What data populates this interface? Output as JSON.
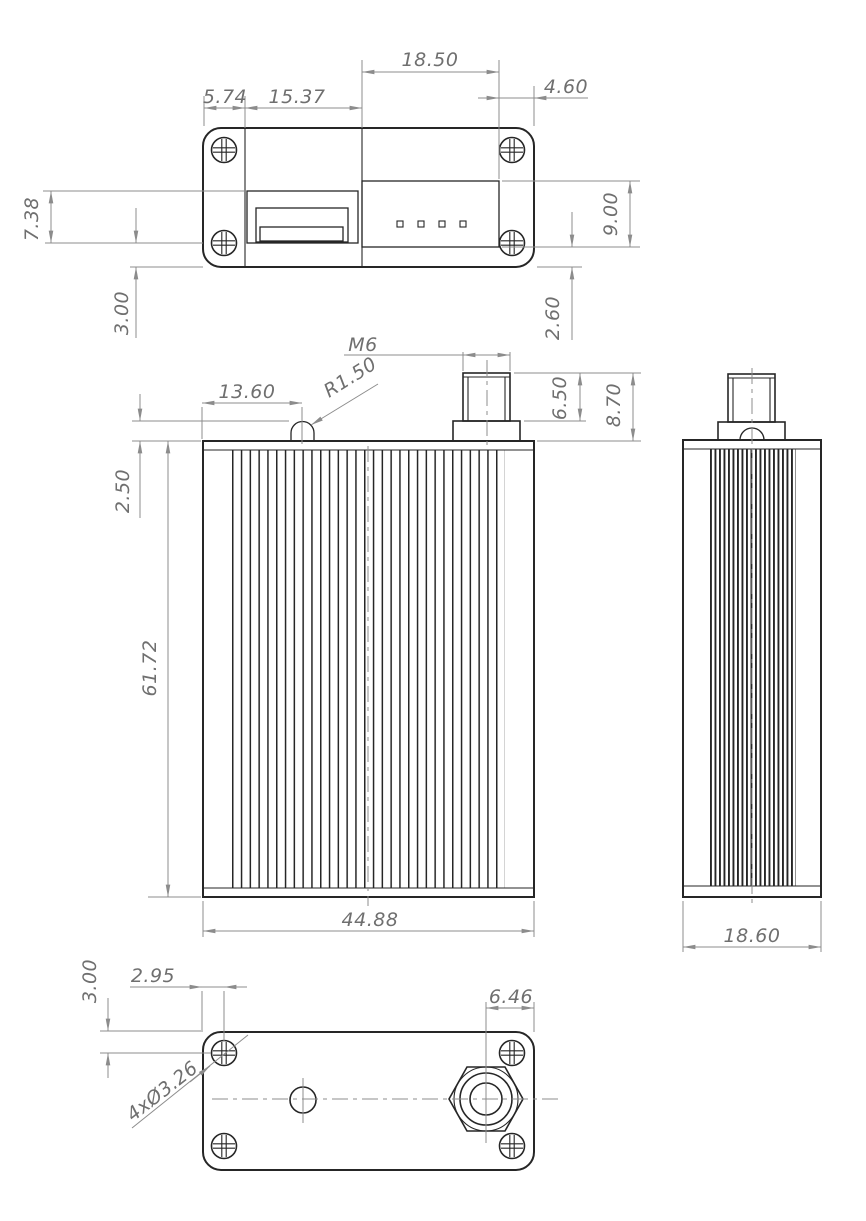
{
  "drawing": {
    "top_view": {
      "dim_5_74": "5.74",
      "dim_15_37": "15.37",
      "dim_18_50": "18.50",
      "dim_4_60": "4.60",
      "dim_7_38": "7.38",
      "dim_3_00": "3.00",
      "dim_9_00": "9.00",
      "dim_2_60": "2.60"
    },
    "front_view": {
      "dim_m6": "M6",
      "dim_r1_50": "R1.50",
      "dim_13_60": "13.60",
      "dim_2_50": "2.50",
      "dim_6_50": "6.50",
      "dim_8_70": "8.70",
      "dim_61_72": "61.72",
      "dim_44_88": "44.88"
    },
    "side_view": {
      "dim_18_60": "18.60"
    },
    "bottom_view": {
      "dim_3_00": "3.00",
      "dim_2_95": "2.95",
      "dim_6_46": "6.46",
      "dim_holes": "4xØ3.26"
    },
    "colors": {
      "object_line": "#262626",
      "dimension_line": "#8c8c8c",
      "dimension_text": "#6f6f6f",
      "background": "#ffffff"
    }
  }
}
